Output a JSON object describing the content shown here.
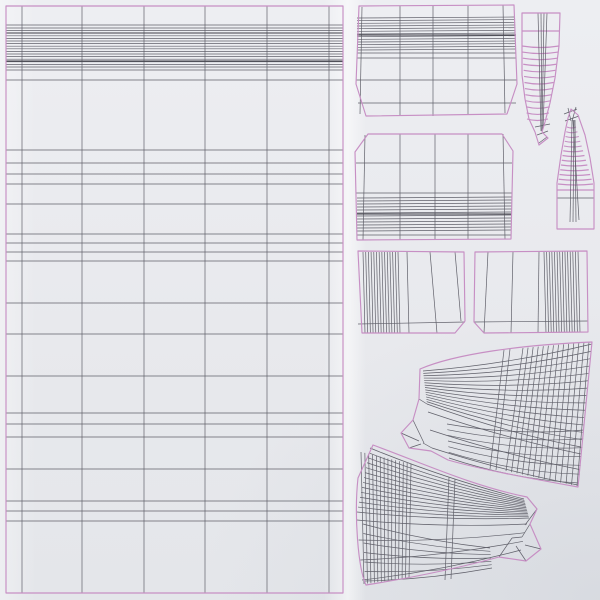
{
  "canvas": {
    "width": 600,
    "height": 600,
    "description": "UV wireframe unwrap layout of fabric/blind 3D model pieces on light paper background"
  },
  "colors": {
    "background": "#e9eaee",
    "outline": "#c78fc4",
    "wire": "#60606a",
    "wire_dark": "#3f3f48",
    "stroke_width_wire": 0.7,
    "stroke_width_outline": 1.15
  },
  "pieces": [
    {
      "name": "uv-island-main-panel",
      "outline": [
        "M6,6 L343,6 L343,593 L6,593 Z"
      ],
      "lines": [
        [
          22,
          6,
          22,
          593
        ],
        [
          82,
          6,
          82,
          593
        ],
        [
          144,
          6,
          144,
          593
        ],
        [
          205,
          6,
          205,
          593
        ],
        [
          267,
          6,
          267,
          593
        ],
        [
          329,
          6,
          329,
          593
        ],
        [
          6,
          25,
          343,
          25
        ],
        [
          6,
          70,
          343,
          70
        ],
        [
          6,
          80,
          343,
          80
        ],
        [
          6,
          150,
          343,
          150
        ],
        [
          6,
          163,
          343,
          163
        ],
        [
          6,
          174,
          343,
          174
        ],
        [
          6,
          184,
          343,
          184
        ],
        [
          6,
          204,
          343,
          204
        ],
        [
          6,
          234,
          343,
          234
        ],
        [
          6,
          243,
          343,
          243
        ],
        [
          6,
          252,
          343,
          252
        ],
        [
          6,
          261,
          343,
          261
        ],
        [
          6,
          303,
          343,
          303
        ],
        [
          6,
          334,
          343,
          334
        ],
        [
          6,
          376,
          343,
          376
        ],
        [
          6,
          413,
          343,
          413
        ],
        [
          6,
          424,
          343,
          424
        ],
        [
          6,
          437,
          343,
          437
        ],
        [
          6,
          469,
          343,
          469
        ],
        [
          6,
          501,
          343,
          501
        ],
        [
          6,
          511,
          343,
          511
        ],
        [
          6,
          521,
          343,
          521
        ],
        [
          6,
          33,
          343,
          33,
          "dark"
        ],
        [
          6,
          61,
          343,
          61,
          "dark"
        ]
      ],
      "fans": [
        {
          "n": 16,
          "a1": [
            6,
            28
          ],
          "a2": [
            6,
            67
          ],
          "b1": [
            343,
            28
          ],
          "b2": [
            343,
            67
          ]
        }
      ]
    },
    {
      "name": "uv-island-top-band-panel",
      "outline": [
        "M359,6 L514,5 L517,84 L507,114 L366,116 L356,84 Z"
      ],
      "lines": [
        [
          362,
          7,
          360,
          114
        ],
        [
          400,
          6,
          400,
          115
        ],
        [
          433,
          6,
          433,
          116
        ],
        [
          468,
          6,
          468,
          115
        ],
        [
          503,
          5,
          505,
          113
        ],
        [
          357,
          53,
          516,
          53
        ],
        [
          357,
          58,
          516,
          58
        ],
        [
          356,
          80,
          517,
          80
        ],
        [
          358,
          103,
          516,
          103
        ],
        [
          357,
          35,
          516,
          35,
          "dark"
        ]
      ],
      "fans": [
        {
          "n": 13,
          "a1": [
            357,
            18
          ],
          "a2": [
            357,
            50
          ],
          "b1": [
            515,
            17
          ],
          "b2": [
            516,
            49
          ]
        }
      ]
    },
    {
      "name": "uv-island-lower-band-panel",
      "outline": [
        "M368,134 L502,134 L513,151 L511,239 L357,240 L355,152 Z"
      ],
      "lines": [
        [
          365,
          135,
          363,
          240
        ],
        [
          400,
          134,
          400,
          240
        ],
        [
          435,
          134,
          435,
          240
        ],
        [
          468,
          134,
          468,
          239
        ],
        [
          503,
          134,
          505,
          239
        ],
        [
          356,
          163,
          512,
          163
        ],
        [
          356,
          193,
          512,
          193
        ],
        [
          357,
          235,
          511,
          235
        ],
        [
          357,
          214,
          511,
          214,
          "dark"
        ]
      ],
      "fans": [
        {
          "n": 12,
          "a1": [
            357,
            198
          ],
          "a2": [
            357,
            231
          ],
          "b1": [
            512,
            197
          ],
          "b2": [
            511,
            230
          ]
        }
      ]
    },
    {
      "name": "uv-island-pleat-strip-left",
      "outline": [
        "M358,251 L464,252 L465,321 L455,333 L362,333 Z"
      ],
      "lines": [
        [
          407,
          252,
          409,
          333
        ],
        [
          430,
          252,
          437,
          333
        ],
        [
          455,
          252,
          461,
          321
        ],
        [
          358,
          324,
          465,
          322
        ]
      ],
      "fans": [
        {
          "n": 14,
          "a1": [
            363,
            252
          ],
          "a2": [
            398,
            252
          ],
          "b1": [
            365,
            333
          ],
          "b2": [
            400,
            333
          ]
        }
      ]
    },
    {
      "name": "uv-island-pleat-strip-right",
      "outline": [
        "M475,252 L587,251 L588,332 L484,333 L474,322 Z"
      ],
      "lines": [
        [
          488,
          252,
          484,
          333
        ],
        [
          513,
          252,
          511,
          333
        ],
        [
          539,
          252,
          538,
          333
        ],
        [
          474,
          322,
          588,
          321
        ]
      ],
      "fans": [
        {
          "n": 14,
          "a1": [
            544,
            252
          ],
          "a2": [
            578,
            251
          ],
          "b1": [
            546,
            333
          ],
          "b2": [
            580,
            332
          ]
        }
      ]
    },
    {
      "name": "uv-island-tassel-large",
      "outline": [
        "M522,13 L560,13 L559,46 L555,78 L550,103 L545,122 L542,132 L548,138 L539,145 L535,132 L529,119 L525,99 L522,75 L522,46 Z"
      ],
      "lines": [
        [
          522,
          31,
          560,
          31,
          "outline"
        ],
        [
          538,
          13,
          541,
          131
        ],
        [
          541,
          13,
          542,
          131
        ],
        [
          544,
          13,
          542,
          131
        ],
        [
          547,
          13,
          543,
          129
        ],
        [
          535,
          127,
          550,
          124
        ],
        [
          537,
          135,
          548,
          131
        ],
        [
          539,
          143,
          547,
          137
        ]
      ],
      "fans": [
        {
          "n": 13,
          "a1": [
            522,
            46
          ],
          "a2": [
            527,
            119
          ],
          "b1": [
            559,
            46
          ],
          "b2": [
            548,
            119
          ],
          "q": [
            0,
            3
          ],
          "c": "outline"
        }
      ]
    },
    {
      "name": "uv-island-tassel-small",
      "outline": [
        "M571,109 L578,115 L585,135 L590,158 L594,183 L594,229 L557,229 L557,183 L561,155 L565,132 L568,118 Z"
      ],
      "lines": [
        [
          557,
          190,
          594,
          190,
          "outline"
        ],
        [
          557,
          198,
          594,
          198
        ],
        [
          572,
          121,
          570,
          222
        ],
        [
          574,
          120,
          573,
          222
        ],
        [
          575,
          120,
          576,
          222
        ],
        [
          573,
          120,
          579,
          220
        ],
        [
          564,
          114,
          577,
          109
        ],
        [
          565,
          121,
          579,
          116
        ],
        [
          568,
          108,
          571,
          121
        ],
        [
          576,
          107,
          572,
          121
        ]
      ],
      "fans": [
        {
          "n": 13,
          "a1": [
            567,
            127
          ],
          "a2": [
            558,
            184
          ],
          "b1": [
            576,
            127
          ],
          "b2": [
            593,
            184
          ],
          "q": [
            0,
            2
          ],
          "c": "outline"
        }
      ]
    },
    {
      "name": "uv-island-swag-upper",
      "outline": [
        "M420,369 C455,354 520,345 592,342 L578,487 C528,478 479,469 448,460 L431,451 L409,448 L401,433 L413,420 L419,399 Z"
      ],
      "lines": [
        [
          504,
          350,
          490,
          469
        ],
        [
          510,
          349,
          496,
          470
        ],
        [
          401,
          433,
          419,
          441
        ],
        [
          413,
          420,
          424,
          443
        ],
        [
          409,
          448,
          421,
          444
        ],
        [
          419,
          399,
          427,
          404
        ],
        [
          423,
          443,
          432,
          448
        ]
      ],
      "fans": [
        {
          "n": 15,
          "a1": [
            423,
            371
          ],
          "a2": [
            427,
            404
          ],
          "b1": [
            592,
            344
          ],
          "b2": [
            581,
            447
          ],
          "q": [
            0,
            7
          ]
        },
        {
          "n": 3,
          "a1": [
            428,
            412
          ],
          "a2": [
            432,
            448
          ],
          "b1": [
            581,
            454
          ],
          "b2": [
            578,
            485
          ],
          "q": [
            0,
            5
          ]
        },
        {
          "n": 14,
          "a1": [
            523,
            348
          ],
          "a2": [
            589,
            342
          ],
          "b1": [
            506,
            471
          ],
          "b2": [
            577,
            486
          ]
        },
        {
          "n": 7,
          "a1": [
            447,
            424
          ],
          "a2": [
            449,
            458
          ],
          "b1": [
            584,
            430
          ],
          "b2": [
            579,
            483
          ],
          "q": [
            0,
            9
          ]
        }
      ]
    },
    {
      "name": "uv-island-swag-lower",
      "outline": [
        "M373,445 C420,462 472,486 527,497 L537,509 L530,524 L541,549 L526,561 L499,557 C455,569 410,578 366,585 C358,568 354,515 358,478 Z"
      ],
      "lines": [
        [
          449,
          477,
          445,
          580
        ],
        [
          455,
          479,
          451,
          579
        ],
        [
          527,
          497,
          537,
          509
        ],
        [
          530,
          524,
          522,
          537
        ],
        [
          541,
          549,
          525,
          545
        ],
        [
          526,
          561,
          516,
          546
        ],
        [
          499,
          557,
          512,
          538
        ],
        [
          512,
          538,
          522,
          537
        ],
        [
          537,
          509,
          525,
          525
        ]
      ],
      "fans": [
        {
          "n": 14,
          "a1": [
            361,
            452
          ],
          "a2": [
            411,
            464
          ],
          "b1": [
            364,
            584
          ],
          "b2": [
            409,
            578
          ]
        },
        {
          "n": 14,
          "a1": [
            524,
            499
          ],
          "a2": [
            529,
            518
          ],
          "b1": [
            370,
            448
          ],
          "b2": [
            357,
            512
          ],
          "q": [
            0,
            6
          ]
        },
        {
          "n": 4,
          "a1": [
            527,
            524
          ],
          "a2": [
            521,
            550
          ],
          "b1": [
            357,
            520
          ],
          "b2": [
            362,
            580
          ],
          "q": [
            0,
            6
          ]
        },
        {
          "n": 7,
          "a1": [
            363,
            524
          ],
          "a2": [
            365,
            581
          ],
          "b1": [
            490,
            548
          ],
          "b2": [
            492,
            568
          ],
          "q": [
            0,
            5
          ]
        }
      ]
    }
  ]
}
